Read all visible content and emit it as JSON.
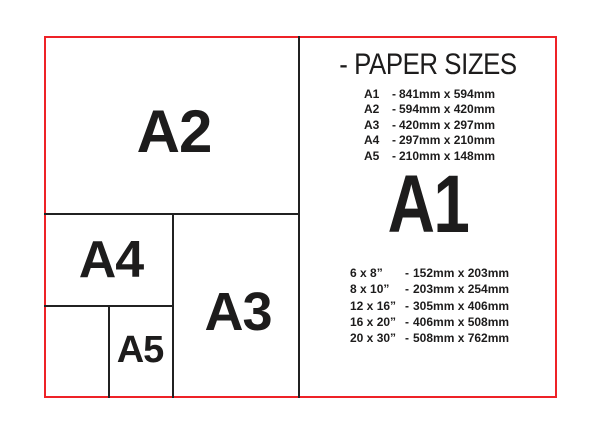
{
  "colors": {
    "red_border": "#ee2227",
    "divider_line": "#212121",
    "text": "#1d1c1c"
  },
  "diagram": {
    "a2_label": "A2",
    "a4_label": "A4",
    "a3_label": "A3",
    "a5_label": "A5"
  },
  "panel": {
    "title": "- PAPER SIZES",
    "big_label": "A1",
    "a_sizes": [
      {
        "name": "A1",
        "sep": "-",
        "dims": "841mm x 594mm"
      },
      {
        "name": "A2",
        "sep": "-",
        "dims": "594mm x 420mm"
      },
      {
        "name": "A3",
        "sep": "-",
        "dims": "420mm x 297mm"
      },
      {
        "name": "A4",
        "sep": "-",
        "dims": "297mm x 210mm"
      },
      {
        "name": "A5",
        "sep": "-",
        "dims": "210mm x 148mm"
      }
    ],
    "inch_sizes": [
      {
        "name": "6 x 8”",
        "sep": "-",
        "dims": "152mm x 203mm"
      },
      {
        "name": "8 x 10”",
        "sep": "-",
        "dims": "203mm x 254mm"
      },
      {
        "name": "12 x 16”",
        "sep": "-",
        "dims": "305mm x 406mm"
      },
      {
        "name": "16 x 20”",
        "sep": "-",
        "dims": "406mm x 508mm"
      },
      {
        "name": "20 x 30”",
        "sep": "-",
        "dims": "508mm x 762mm"
      }
    ]
  }
}
